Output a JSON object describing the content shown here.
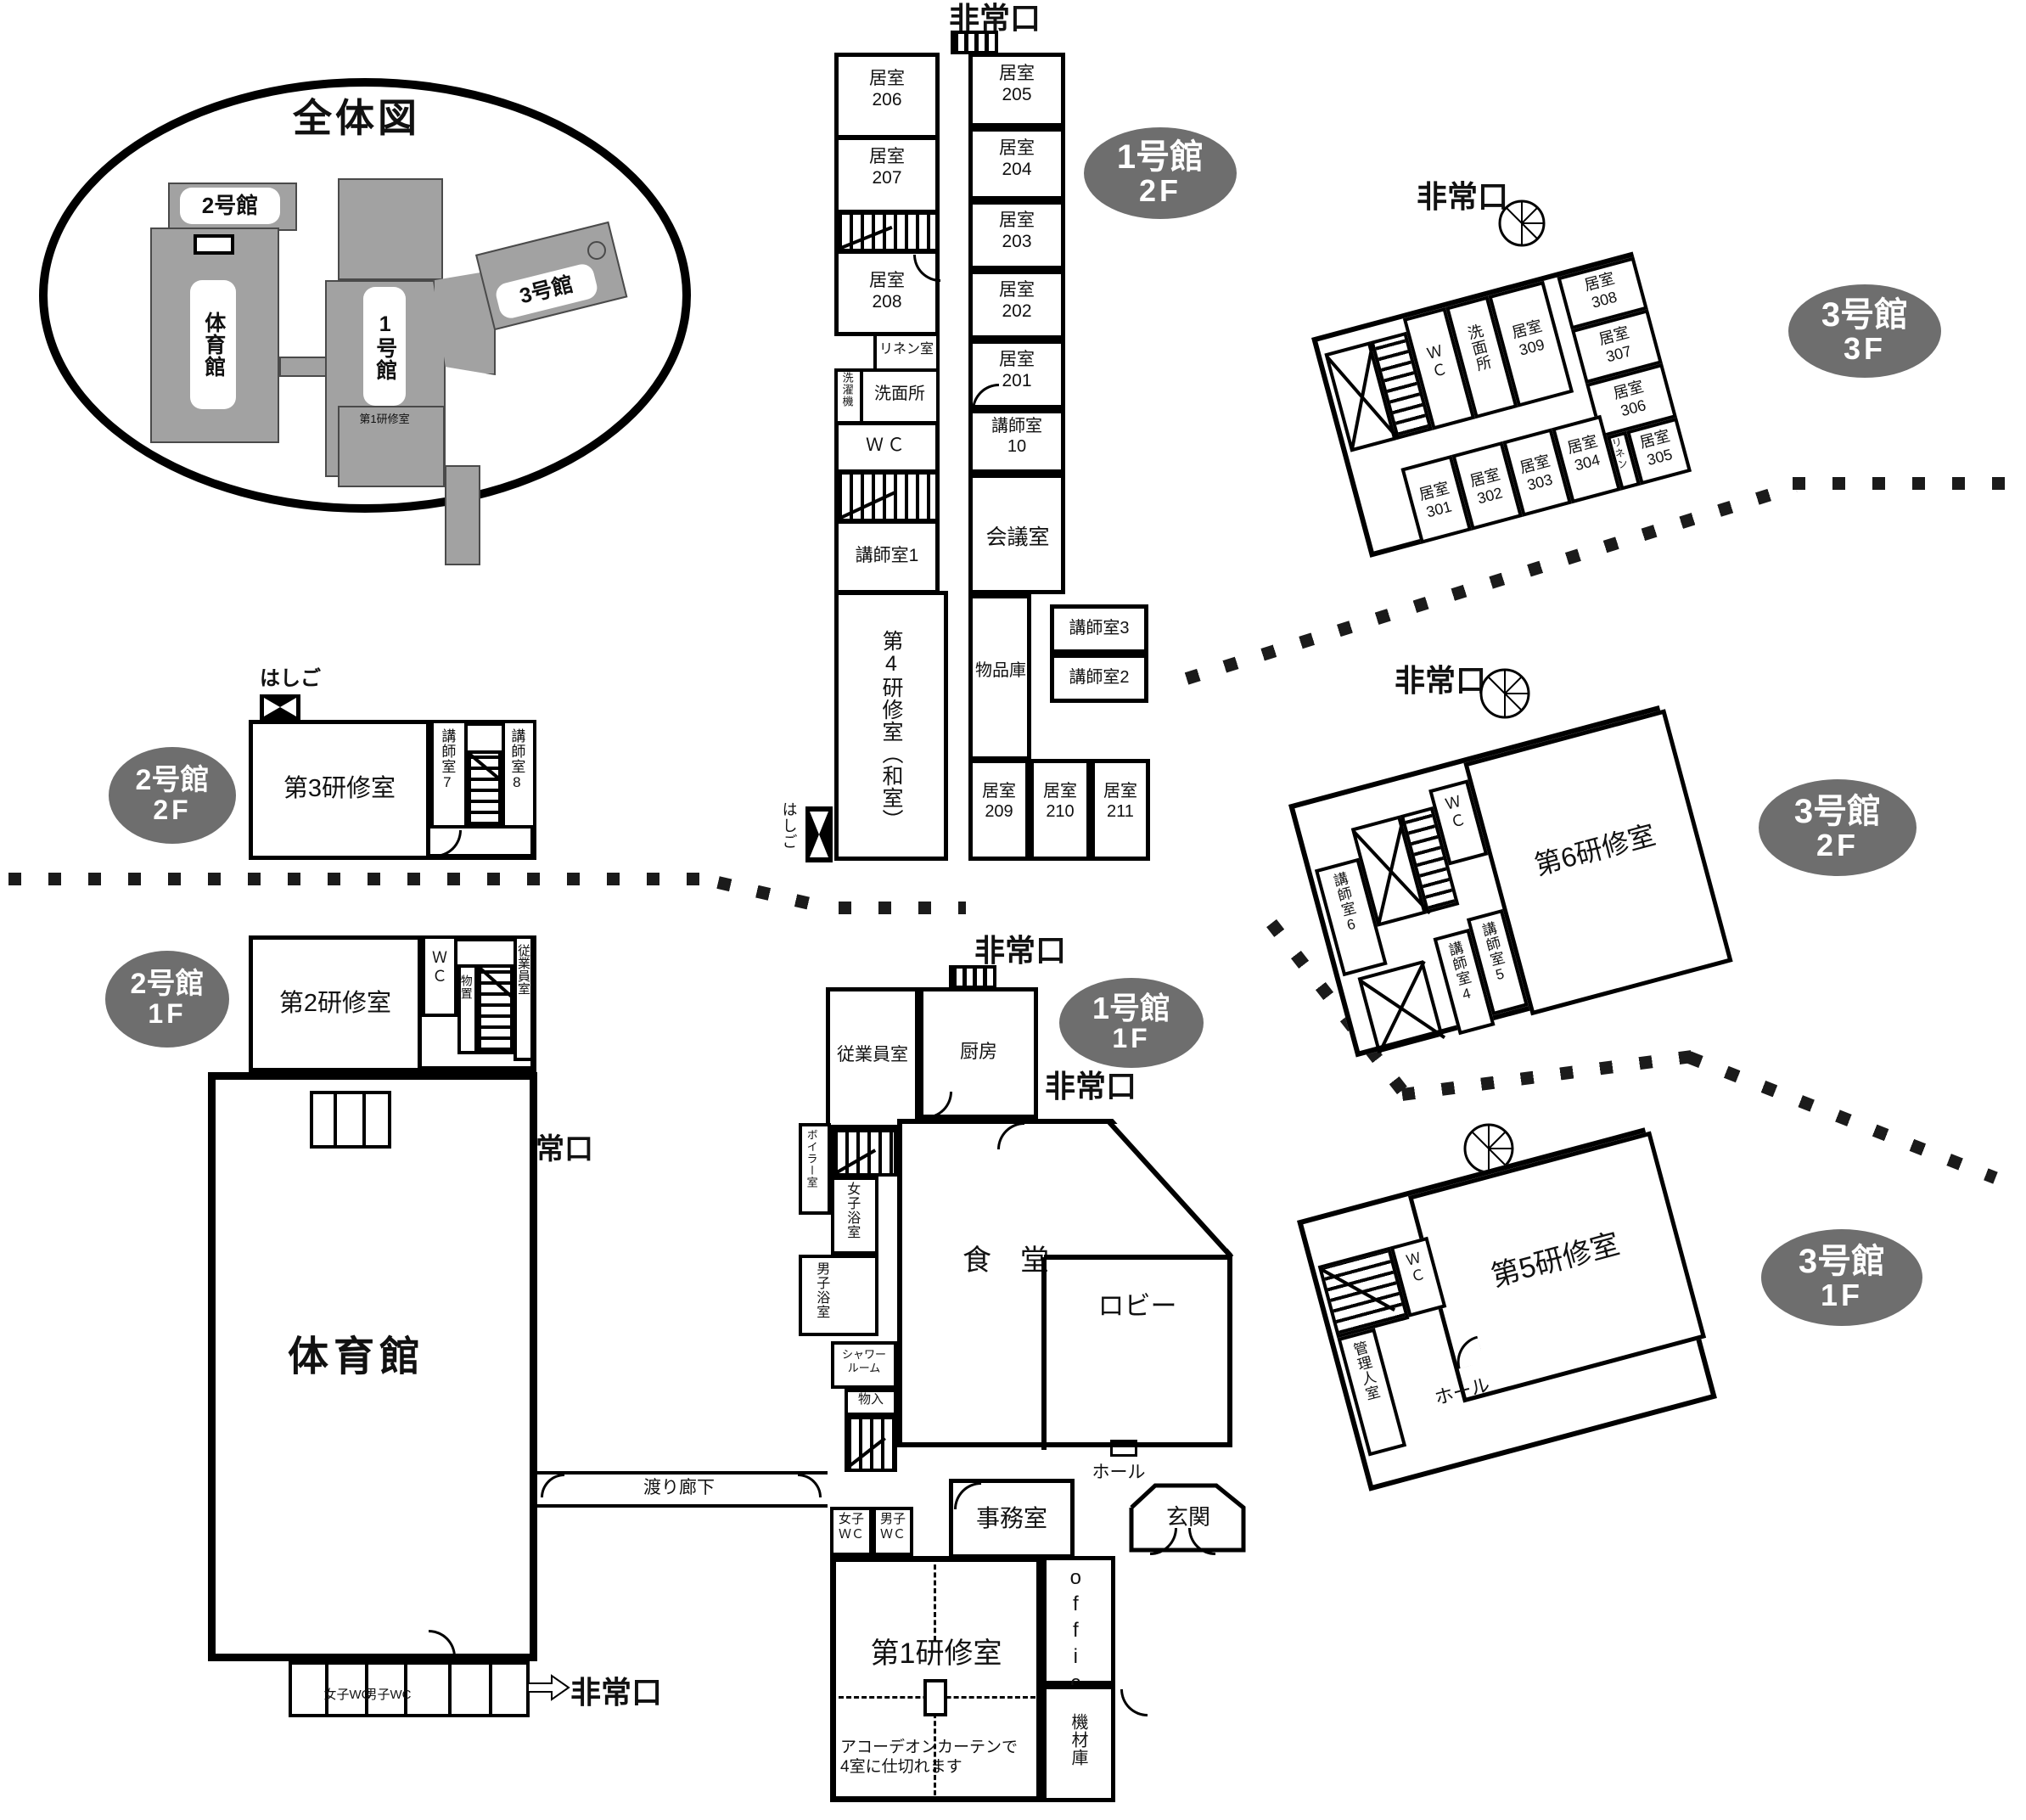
{
  "overview": {
    "title": "全体図",
    "b2": "2号館",
    "gym": "体育館",
    "b1": "1号館",
    "b3": "3号館",
    "room1": "第1研修室"
  },
  "badges": {
    "b1f2n": "1号館",
    "b1f2f": "2F",
    "b3f3n": "3号館",
    "b3f3f": "3F",
    "b2f2n": "2号館",
    "b2f2f": "2F",
    "b3f2n": "3号館",
    "b3f2f": "2F",
    "b2f1n": "2号館",
    "b2f1f": "1F",
    "b1f1n": "1号館",
    "b1f1f": "1F",
    "b3f1n": "3号館",
    "b3f1f": "1F"
  },
  "b1f2": {
    "exit": "非常口",
    "r206": "居室\n206",
    "r207": "居室\n207",
    "r208": "居室\n208",
    "linen": "リネン室",
    "washer": "洗濯機",
    "wash": "洗面所",
    "wc": "ＷＣ",
    "k1": "講師室1",
    "dai4": "第4研修室（和室）",
    "r205": "居室\n205",
    "r204": "居室\n204",
    "r203": "居室\n203",
    "r202": "居室\n202",
    "r201": "居室\n201",
    "k10": "講師室\n10",
    "meeting": "会議室",
    "storage": "物品庫",
    "k3": "講師室3",
    "k2": "講師室2",
    "r209": "居室\n209",
    "r210": "居室\n210",
    "r211": "居室\n211",
    "ladder": "はしご"
  },
  "b3f3": {
    "exit": "非常口",
    "wc": "Ｗ\nＣ",
    "wash": "洗面所",
    "r309": "居室\n309",
    "r308": "居室\n308",
    "r307": "居室\n307",
    "r306": "居室\n306",
    "r305": "居室\n305",
    "linen": "リネン",
    "r301": "居室\n301",
    "r302": "居室\n302",
    "r303": "居室\n303",
    "r304": "居室\n304"
  },
  "b2f2": {
    "ladder": "はしご",
    "dai3": "第3研修室",
    "k7": "講師室7",
    "k8": "講師室8"
  },
  "b3f2": {
    "exit": "非常口",
    "k6": "講師室6",
    "wc": "Ｗ\nＣ",
    "dai6": "第6研修室",
    "k4": "講師室4",
    "k5": "講師室5"
  },
  "b2f1": {
    "dai2": "第2研修室",
    "wc": "Ｗ\nＣ",
    "oki": "物置",
    "staff": "従業員室",
    "exit": "非常口"
  },
  "gym": {
    "name": "体育館",
    "wwc": "女子WC",
    "mwc": "男子WC",
    "exit": "非常口",
    "corridor": "渡り廊下"
  },
  "b1f1": {
    "exit_top": "非常口",
    "staff": "従業員室",
    "kitchen": "厨房",
    "exit_right": "非常口",
    "boiler": "ボイラー室",
    "wbath": "女子浴室",
    "mbath": "男子浴室",
    "shower": "シャワー\nルーム",
    "mono": "物入",
    "dining": "食　堂",
    "lobby": "ロビー",
    "hall": "ホール",
    "entrance": "玄関",
    "office_jp": "事務室",
    "wwc": "女子\nＷＣ",
    "mwc": "男子\nＷＣ",
    "office_en": "office",
    "dai1": "第1研修室",
    "curtain": "アコーデオンカーテンで\n4室に仕切れます",
    "kizai": "機材庫"
  },
  "b3f1": {
    "wc": "Ｗ\nＣ",
    "dai5": "第5研修室",
    "kanri": "管理人室",
    "hall": "ホール"
  }
}
